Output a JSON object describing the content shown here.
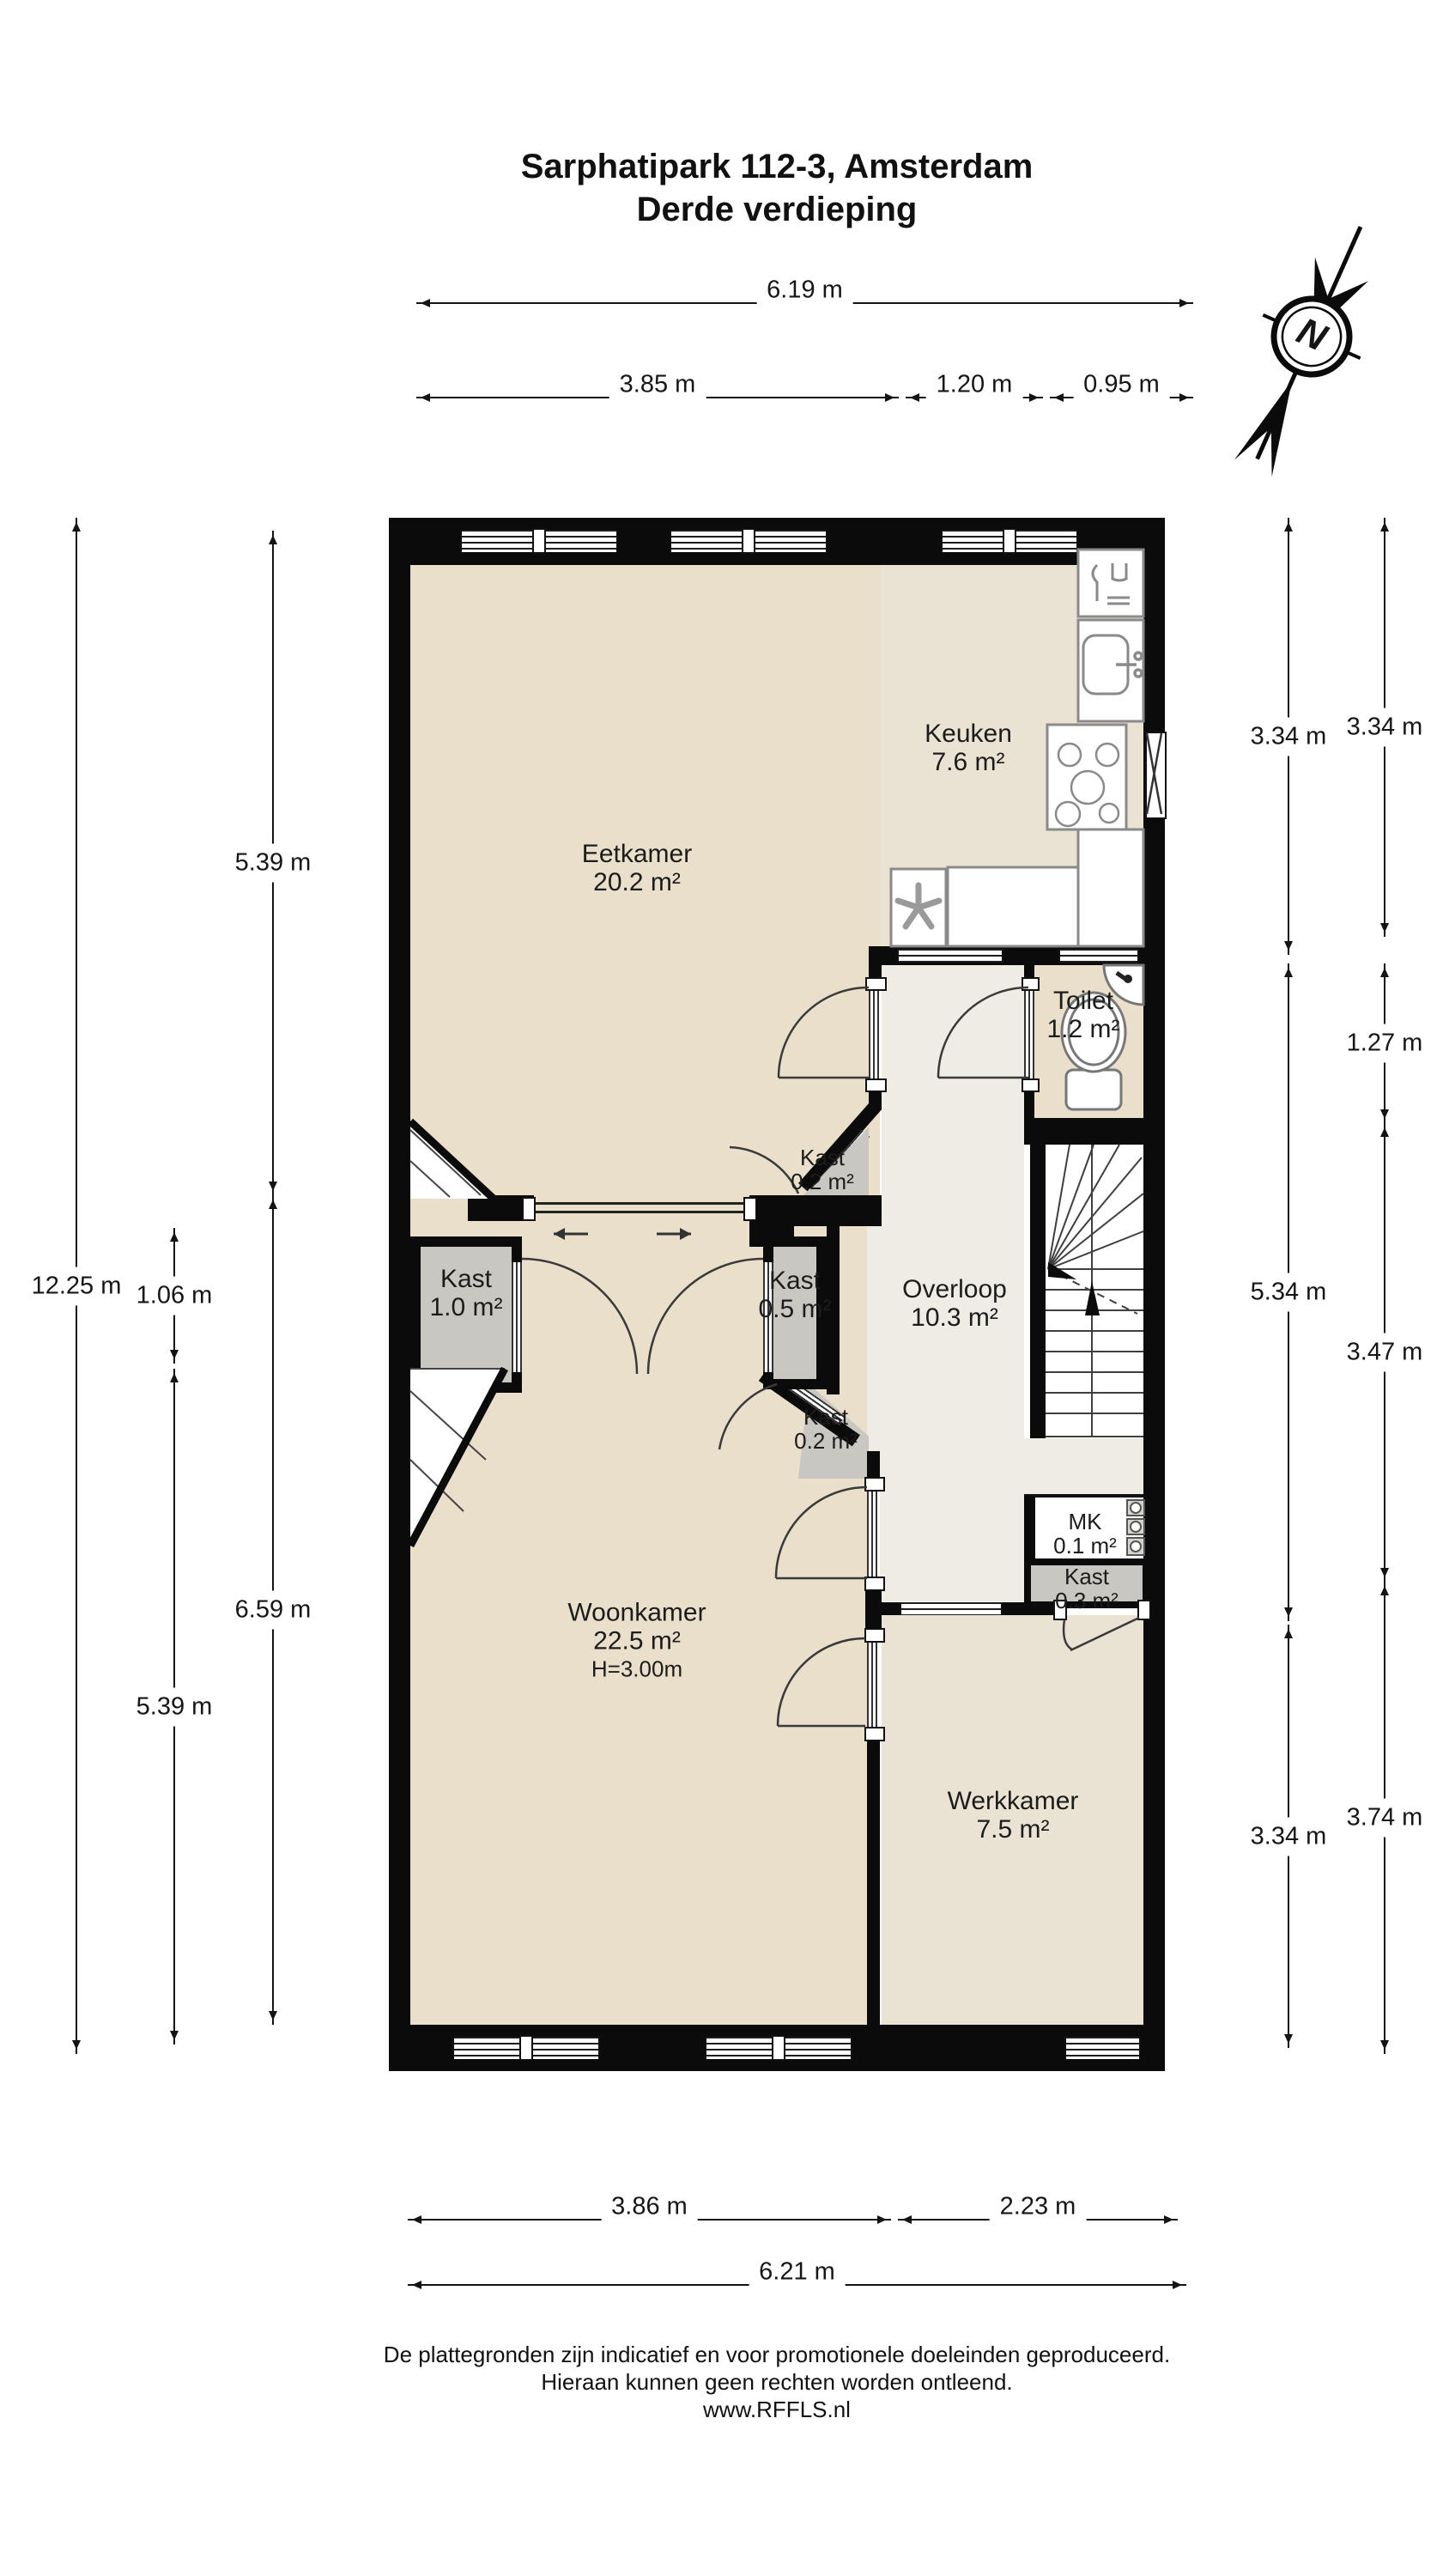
{
  "title": {
    "line1": "Sarphatipark 112-3, Amsterdam",
    "line2": "Derde verdieping"
  },
  "compass": {
    "label": "N"
  },
  "rooms": [
    {
      "name": "Eetkamer",
      "area": "20.2 m²"
    },
    {
      "name": "Keuken",
      "area": "7.6 m²"
    },
    {
      "name": "Toilet",
      "area": "1.2 m²"
    },
    {
      "name": "Kast",
      "area": "0.2 m²"
    },
    {
      "name": "Kast",
      "area": "1.0 m²"
    },
    {
      "name": "Kast",
      "area": "0.5 m²"
    },
    {
      "name": "Overloop",
      "area": "10.3 m²"
    },
    {
      "name": "Kast",
      "area": "0.2 m²"
    },
    {
      "name": "MK",
      "area": "0.1 m²"
    },
    {
      "name": "Kast",
      "area": "0.3 m²"
    },
    {
      "name": "Woonkamer",
      "area": "22.5 m²",
      "height": "H=3.00m"
    },
    {
      "name": "Werkkamer",
      "area": "7.5 m²"
    }
  ],
  "dimensions": {
    "top": [
      {
        "label": "6.19 m"
      },
      {
        "label": "3.85 m"
      },
      {
        "label": "1.20 m"
      },
      {
        "label": "0.95 m"
      }
    ],
    "left": [
      {
        "label": "12.25 m"
      },
      {
        "label": "5.39 m"
      },
      {
        "label": "1.06 m"
      },
      {
        "label": "5.39 m"
      },
      {
        "label": "6.59 m"
      }
    ],
    "right": [
      {
        "label": "3.34 m"
      },
      {
        "label": "3.34 m"
      },
      {
        "label": "1.27 m"
      },
      {
        "label": "5.34 m"
      },
      {
        "label": "3.47 m"
      },
      {
        "label": "3.34 m"
      },
      {
        "label": "3.74 m"
      }
    ],
    "bottom": [
      {
        "label": "3.86 m"
      },
      {
        "label": "2.23 m"
      },
      {
        "label": "6.21 m"
      }
    ]
  },
  "footer": {
    "line1": "De plattegronden zijn indicatief en voor promotionele doeleinden geproduceerd.",
    "line2": "Hieraan kunnen geen rechten worden ontleend.",
    "line3": "www.RFFLS.nl"
  }
}
